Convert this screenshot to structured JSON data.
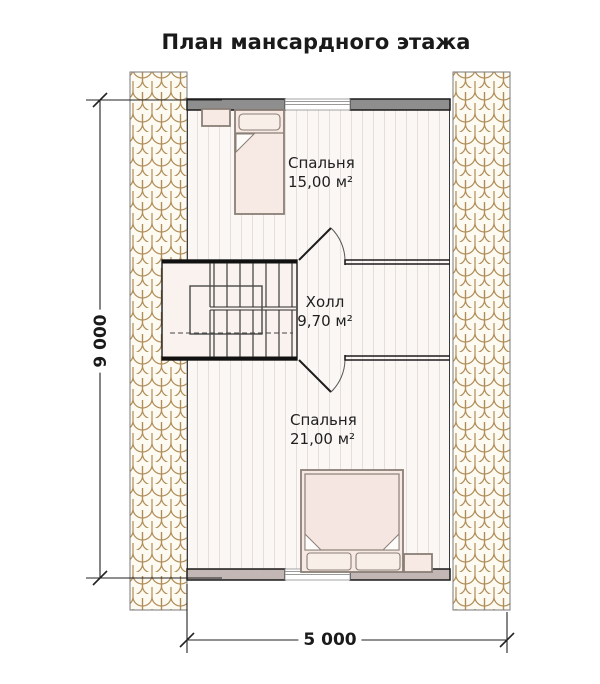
{
  "title": "План мансардного этажа",
  "rooms": [
    {
      "name": "Спальня",
      "area": "15,00 м²"
    },
    {
      "name": "Холл",
      "area": "9,70 м²"
    },
    {
      "name": "Спальня",
      "area": "21,00 м²"
    }
  ],
  "dimensions": {
    "height_mm": "9 000",
    "width_mm": "5 000"
  },
  "colors": {
    "shingle_outline": "#b08c58",
    "shingle_fill": "#fdfaf1",
    "floor": "#fbf7f4",
    "plank_line": "#e6dedb",
    "wall_top": "#8e8e8e",
    "wall_bottom": "#c3b7b5",
    "wall_outline": "#1a1a1a",
    "furniture_fill": "#f7e9e4",
    "furniture_outline": "#8a7f76",
    "stair_fill": "#f9f2ee",
    "line": "#222222",
    "text": "#1a1a1a"
  }
}
